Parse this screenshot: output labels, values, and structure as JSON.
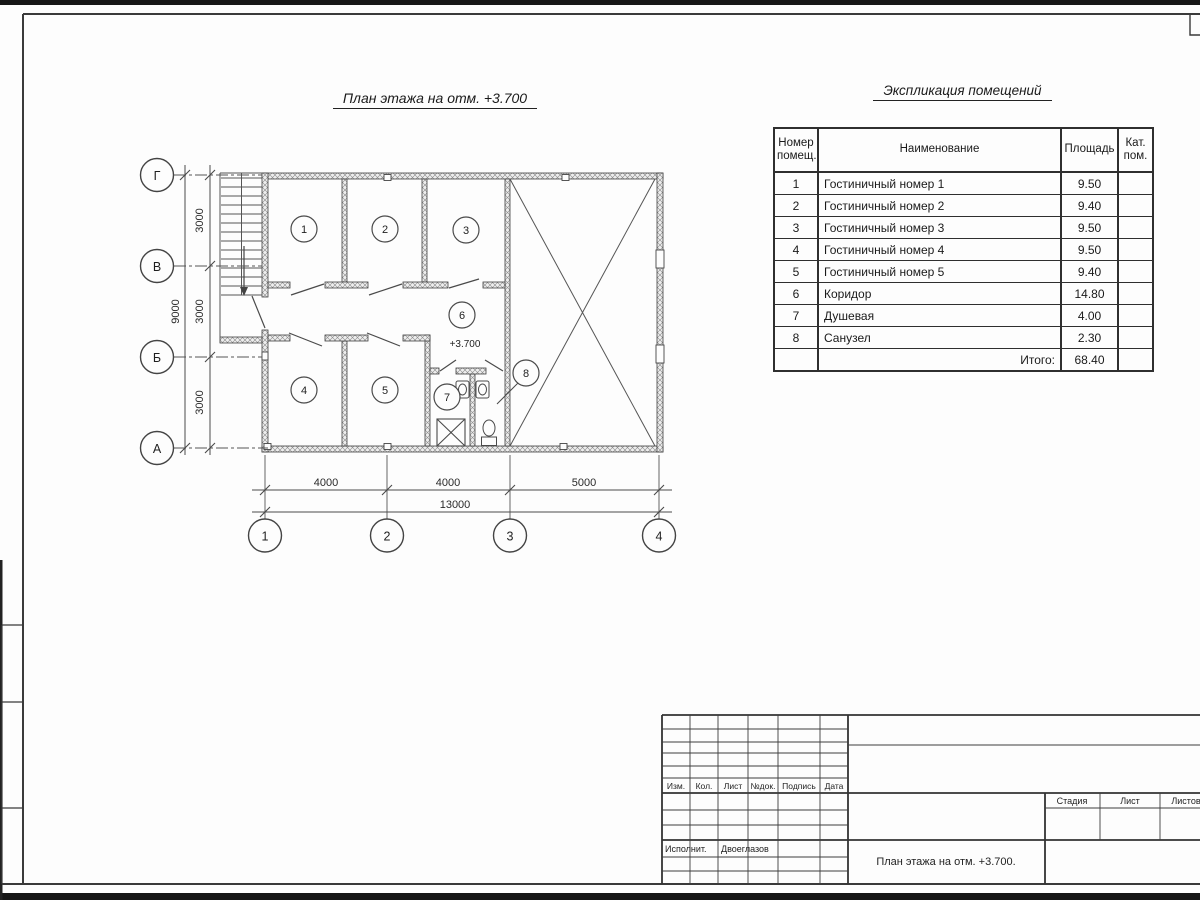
{
  "plan": {
    "title": "План этажа на отм. +3.700",
    "elevation_mark": "+3.700",
    "axes_vertical": [
      "Г",
      "В",
      "Б",
      "А"
    ],
    "axes_horizontal": [
      "1",
      "2",
      "3",
      "4"
    ],
    "rooms": [
      "1",
      "2",
      "3",
      "4",
      "5",
      "6",
      "7",
      "8"
    ],
    "dimensions": {
      "horizontal_segments": [
        "4000",
        "4000",
        "5000"
      ],
      "horizontal_total": "13000",
      "vertical_segments": [
        "3000",
        "3000",
        "3000"
      ],
      "vertical_total": "9000"
    }
  },
  "room_table": {
    "title": "Экспликация помещений",
    "headers": {
      "num": "Номер помещ.",
      "name": "Наименование",
      "area": "Площадь",
      "cat": "Кат. пом."
    },
    "rows": [
      {
        "num": "1",
        "name": "Гостиничный номер 1",
        "area": "9.50",
        "cat": ""
      },
      {
        "num": "2",
        "name": "Гостиничный номер 2",
        "area": "9.40",
        "cat": ""
      },
      {
        "num": "3",
        "name": "Гостиничный номер 3",
        "area": "9.50",
        "cat": ""
      },
      {
        "num": "4",
        "name": "Гостиничный номер 4",
        "area": "9.50",
        "cat": ""
      },
      {
        "num": "5",
        "name": "Гостиничный номер 5",
        "area": "9.40",
        "cat": ""
      },
      {
        "num": "6",
        "name": "Коридор",
        "area": "14.80",
        "cat": ""
      },
      {
        "num": "7",
        "name": "Душевая",
        "area": "4.00",
        "cat": ""
      },
      {
        "num": "8",
        "name": "Санузел",
        "area": "2.30",
        "cat": ""
      }
    ],
    "total_label": "Итого:",
    "total_value": "68.40"
  },
  "title_block": {
    "rev_cols": [
      "Изм.",
      "Кол.",
      "Лист",
      "№док.",
      "Подпись",
      "Дата"
    ],
    "executor_label": "Исполнит.",
    "executor_name": "Двоеглазов",
    "stage_label": "Стадия",
    "sheet_label": "Лист",
    "sheets_label": "Листов",
    "doc_title": "План этажа на отм. +3.700."
  }
}
